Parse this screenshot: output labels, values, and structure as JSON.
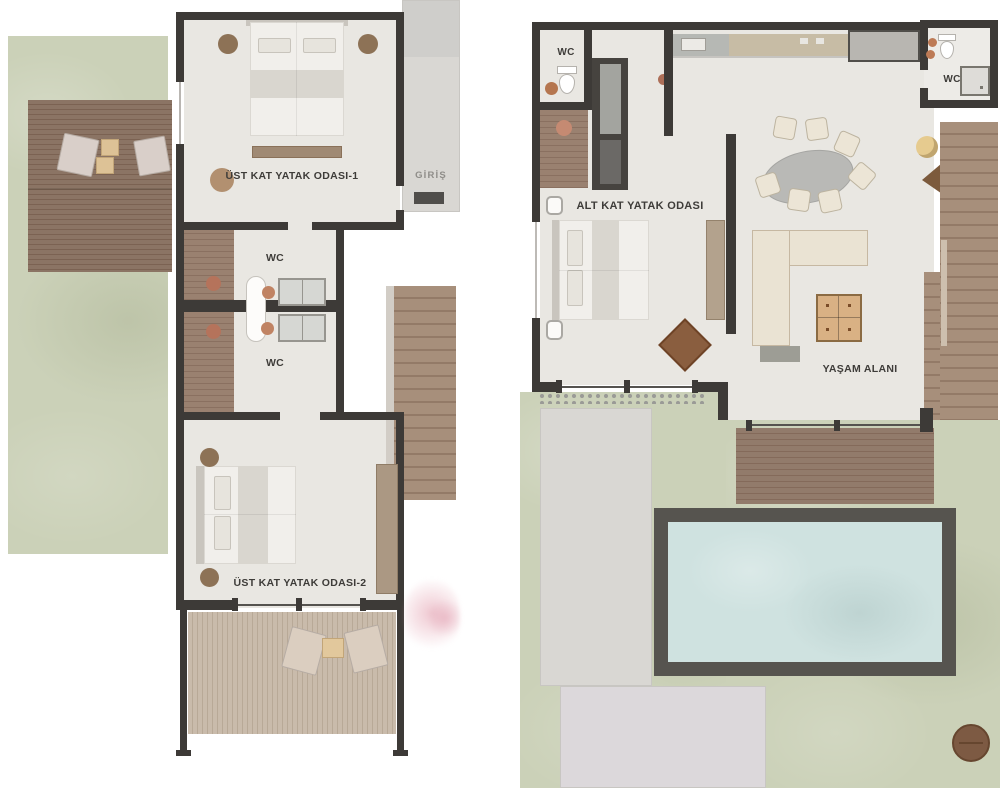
{
  "document": {
    "type": "villa floor plan, two levels side by side",
    "language": "Turkish"
  },
  "plans": {
    "upper_floor": {
      "labels": {
        "bedroom1": "ÜST KAT YATAK ODASI-1",
        "wc_upper": "WC",
        "wc_lower": "WC",
        "entrance": "GİRİŞ",
        "bedroom2": "ÜST KAT YATAK ODASI-2"
      }
    },
    "lower_floor": {
      "labels": {
        "wc_left": "WC",
        "bedroom": "ALT KAT YATAK ODASI",
        "living_area": "YAŞAM ALANI",
        "wc_right": "WC"
      }
    }
  },
  "colors": {
    "background": "#ffffff",
    "walls": "#3d3a37",
    "interior_floor": "#e9e7e2",
    "lawn": "#cbd1b8",
    "deck_wood_dark": "#8b7464",
    "balcony_wood_light": "#c2b3a2",
    "stair_wood": "#a18876",
    "concrete_path": "#d9d7d3",
    "pool_border": "#56544f",
    "pool_water": "#cfe2e0",
    "terracotta_accent": "#b5735b",
    "coffee_table": "#d9b184",
    "rug_diamond": "#8a5e3f",
    "pink_bush": "#e9b4c0"
  }
}
